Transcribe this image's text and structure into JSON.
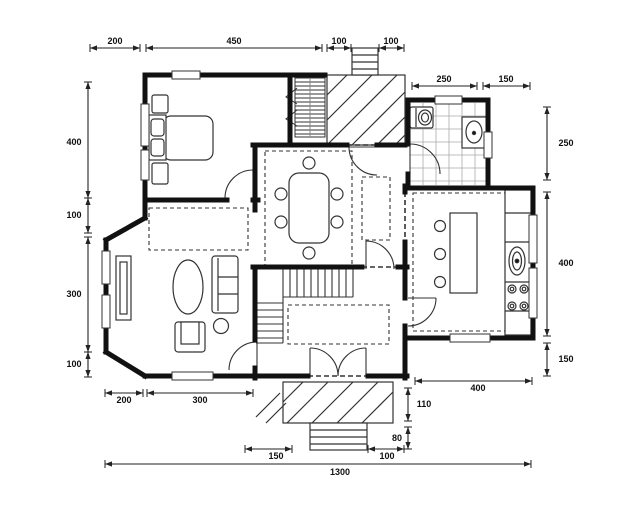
{
  "floorplan": {
    "type": "architectural-floor-plan",
    "wall_color": "#111111",
    "thin_line_color": "#333333",
    "dimension_color": "#222222",
    "tile_grid_color": "#aaaaaa",
    "background": "#ffffff",
    "dimensions": {
      "top": [
        "200",
        "450",
        "100",
        "100"
      ],
      "upper_right": [
        "250",
        "150"
      ],
      "left": [
        "400",
        "100",
        "300",
        "100"
      ],
      "right": [
        "250",
        "400",
        "150"
      ],
      "bottom": [
        "200",
        "300",
        "150",
        "100"
      ],
      "kitchen_bottom": [
        "400"
      ],
      "porch_side": [
        "110",
        "80"
      ],
      "overall_width": "1300"
    },
    "furniture_icons": [
      "double-bed",
      "pillows",
      "nightstand",
      "dining-table",
      "dining-chairs",
      "toilet",
      "washbasin",
      "bathroom-tiles",
      "kitchen-island",
      "bar-stools",
      "kitchen-counter",
      "kitchen-sink",
      "cooktop-burners",
      "sofa",
      "armchair",
      "coffee-table",
      "side-table",
      "sideboard",
      "staircase",
      "chimney",
      "radiator",
      "porch",
      "porch-steps",
      "entry-double-door",
      "rug-dashed"
    ]
  }
}
